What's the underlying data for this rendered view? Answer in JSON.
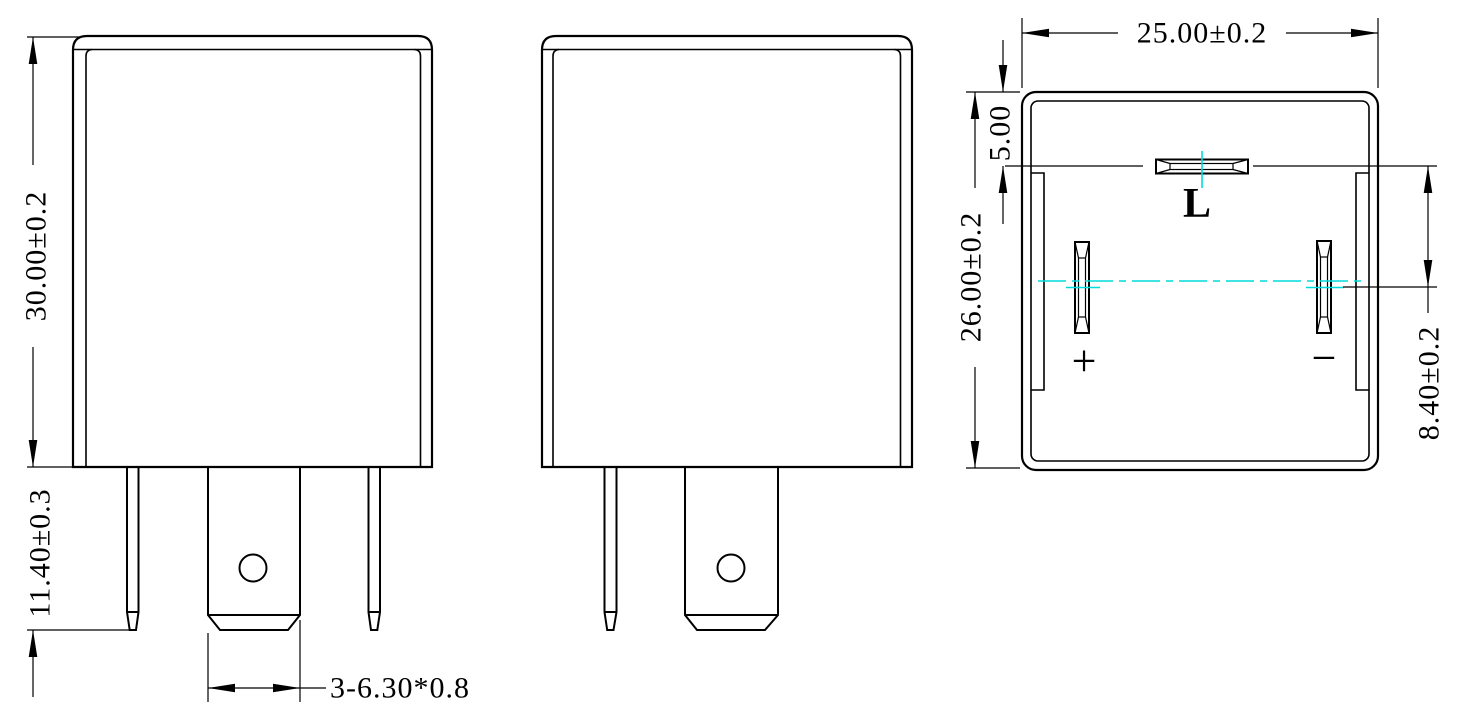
{
  "dimensions": {
    "front_height": "30.00±0.2",
    "pin_length": "11.40±0.3",
    "blade_spec": "3-6.30*0.8",
    "body_width": "25.00±0.2",
    "body_depth": "26.00±0.2",
    "l_pin_offset": "5.00",
    "pin_row_offset": "8.40±0.2"
  },
  "pin_labels": {
    "load": "L",
    "plus": "+",
    "minus": "−"
  },
  "colors": {
    "line": "#000000",
    "centerline": "#00dcdc",
    "background": "#ffffff"
  }
}
